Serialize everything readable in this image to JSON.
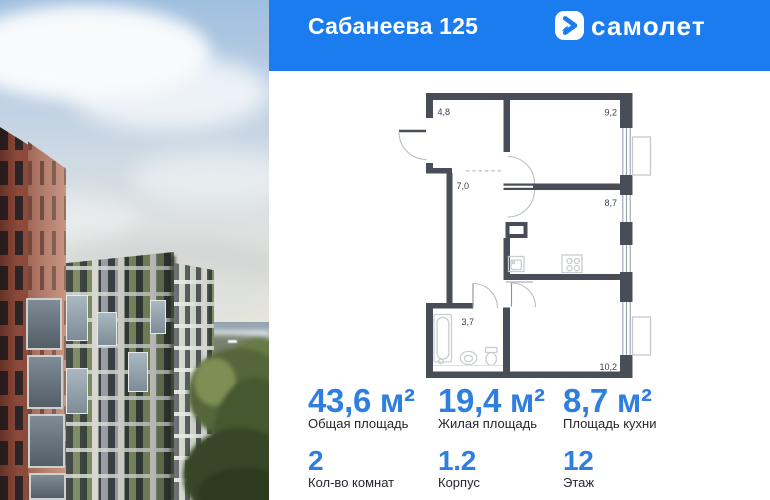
{
  "header": {
    "title": "Сабанеева 125",
    "brand": "самолет"
  },
  "floorplan": {
    "rooms": [
      {
        "name": "hallway",
        "area": "4,8"
      },
      {
        "name": "bedroom",
        "area": "9,2"
      },
      {
        "name": "corridor",
        "area": "7,0"
      },
      {
        "name": "kitchen",
        "area": "8,7"
      },
      {
        "name": "bathroom",
        "area": "3,7"
      },
      {
        "name": "living-room",
        "area": "10,2"
      }
    ]
  },
  "stats": {
    "primary": [
      {
        "value": "43,6 м²",
        "label": "Общая площадь"
      },
      {
        "value": "19,4 м²",
        "label": "Жилая площадь"
      },
      {
        "value": "8,7 м²",
        "label": "Площадь кухни"
      }
    ],
    "secondary": [
      {
        "value": "2",
        "label": "Кол-во комнат"
      },
      {
        "value": "1.2",
        "label": "Корпус"
      },
      {
        "value": "12",
        "label": "Этаж"
      }
    ]
  },
  "colors": {
    "brand_blue": "#1b7cf0",
    "stat_blue": "#2f7fe0",
    "wall": "#494d57",
    "plan_line": "#9aa1ab",
    "fixture": "#c9cdd2"
  }
}
